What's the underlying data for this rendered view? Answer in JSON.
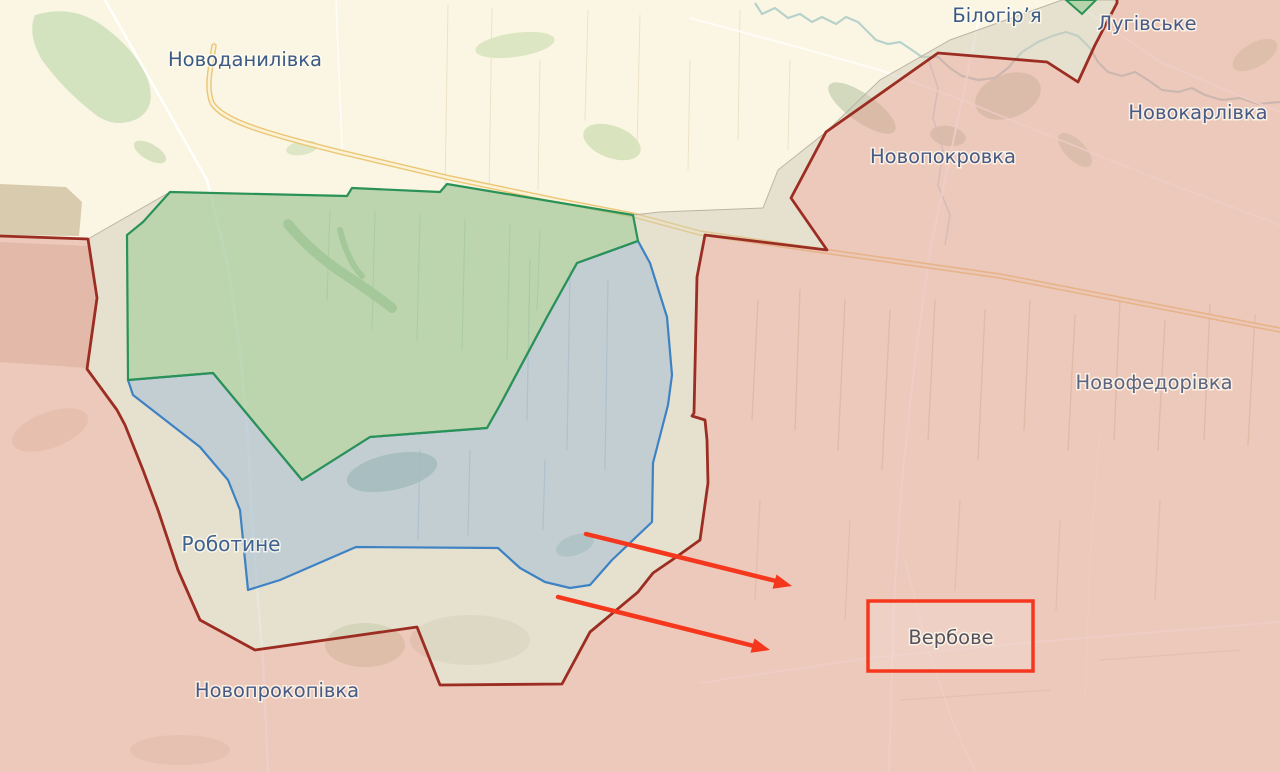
{
  "map": {
    "labels": [
      {
        "text": "Новоданилівка",
        "x": 245,
        "y": 66,
        "color": "#3b5a86",
        "size": 19.5
      },
      {
        "text": "Білогір’я",
        "x": 997,
        "y": 22,
        "color": "#3b5a86",
        "size": 19.5
      },
      {
        "text": "Лугівське",
        "x": 1147,
        "y": 30,
        "color": "#475a85",
        "size": 19.5
      },
      {
        "text": "Новокарлівка",
        "x": 1198,
        "y": 119,
        "color": "#475a85",
        "size": 19.5
      },
      {
        "text": "Новопокровка",
        "x": 943,
        "y": 163,
        "color": "#475a85",
        "size": 19.5
      },
      {
        "text": "Новофедорівка",
        "x": 1154,
        "y": 389,
        "color": "#5c6480",
        "size": 19.5
      },
      {
        "text": "Роботине",
        "x": 231,
        "y": 551,
        "color": "#3f6192",
        "size": 20
      },
      {
        "text": "Новопрокопівка",
        "x": 277,
        "y": 697,
        "color": "#475a85",
        "size": 19.5
      },
      {
        "text": "Вербове",
        "x": 951,
        "y": 644,
        "color": "#56525d",
        "size": 19.5
      }
    ],
    "zone_colors": {
      "occupied_fill": "#f0cec2",
      "gray_zone_fill": "#e9e4d8",
      "liberated_fill": "#cfe5c6",
      "liberated_stroke": "#2a9257",
      "advance_fill": "#cfe0ee",
      "advance_stroke": "#3e82c4",
      "frontline": "#9b2d22",
      "background": "#fbf6e3"
    },
    "annotations": {
      "arrow_color": "#f5371d",
      "arrow_count": "2",
      "highlight_box_color": "#f5371d",
      "highlighted_place": "Вербове"
    },
    "road_colors": {
      "highway_casing": "#ecc778",
      "highway_fill": "#fbf3d8",
      "minor_road": "#ffffff",
      "river": "#b2d0c9"
    }
  }
}
